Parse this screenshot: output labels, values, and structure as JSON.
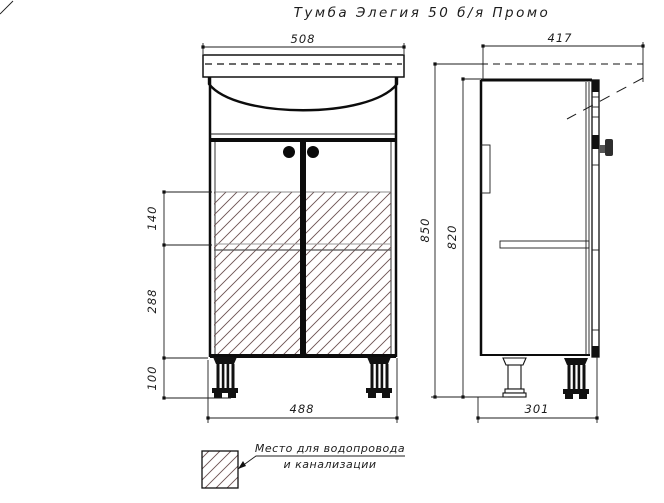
{
  "title": "Тумба Элегия 50 б/я Промо",
  "dimensions": {
    "front": {
      "top_width": "508",
      "bottom_width": "488",
      "hatch_upper_height": "140",
      "hatch_lower_height": "288",
      "legs_height": "100"
    },
    "side": {
      "top_depth": "417",
      "total_height": "850",
      "body_height": "820",
      "bottom_depth": "301"
    }
  },
  "legend": {
    "line1": "Место для водопровода",
    "line2": "и канализации"
  },
  "colors": {
    "ink": "#1c1c1c",
    "hatch": "#6b5151",
    "shelf_line": "#8c8c8c"
  }
}
